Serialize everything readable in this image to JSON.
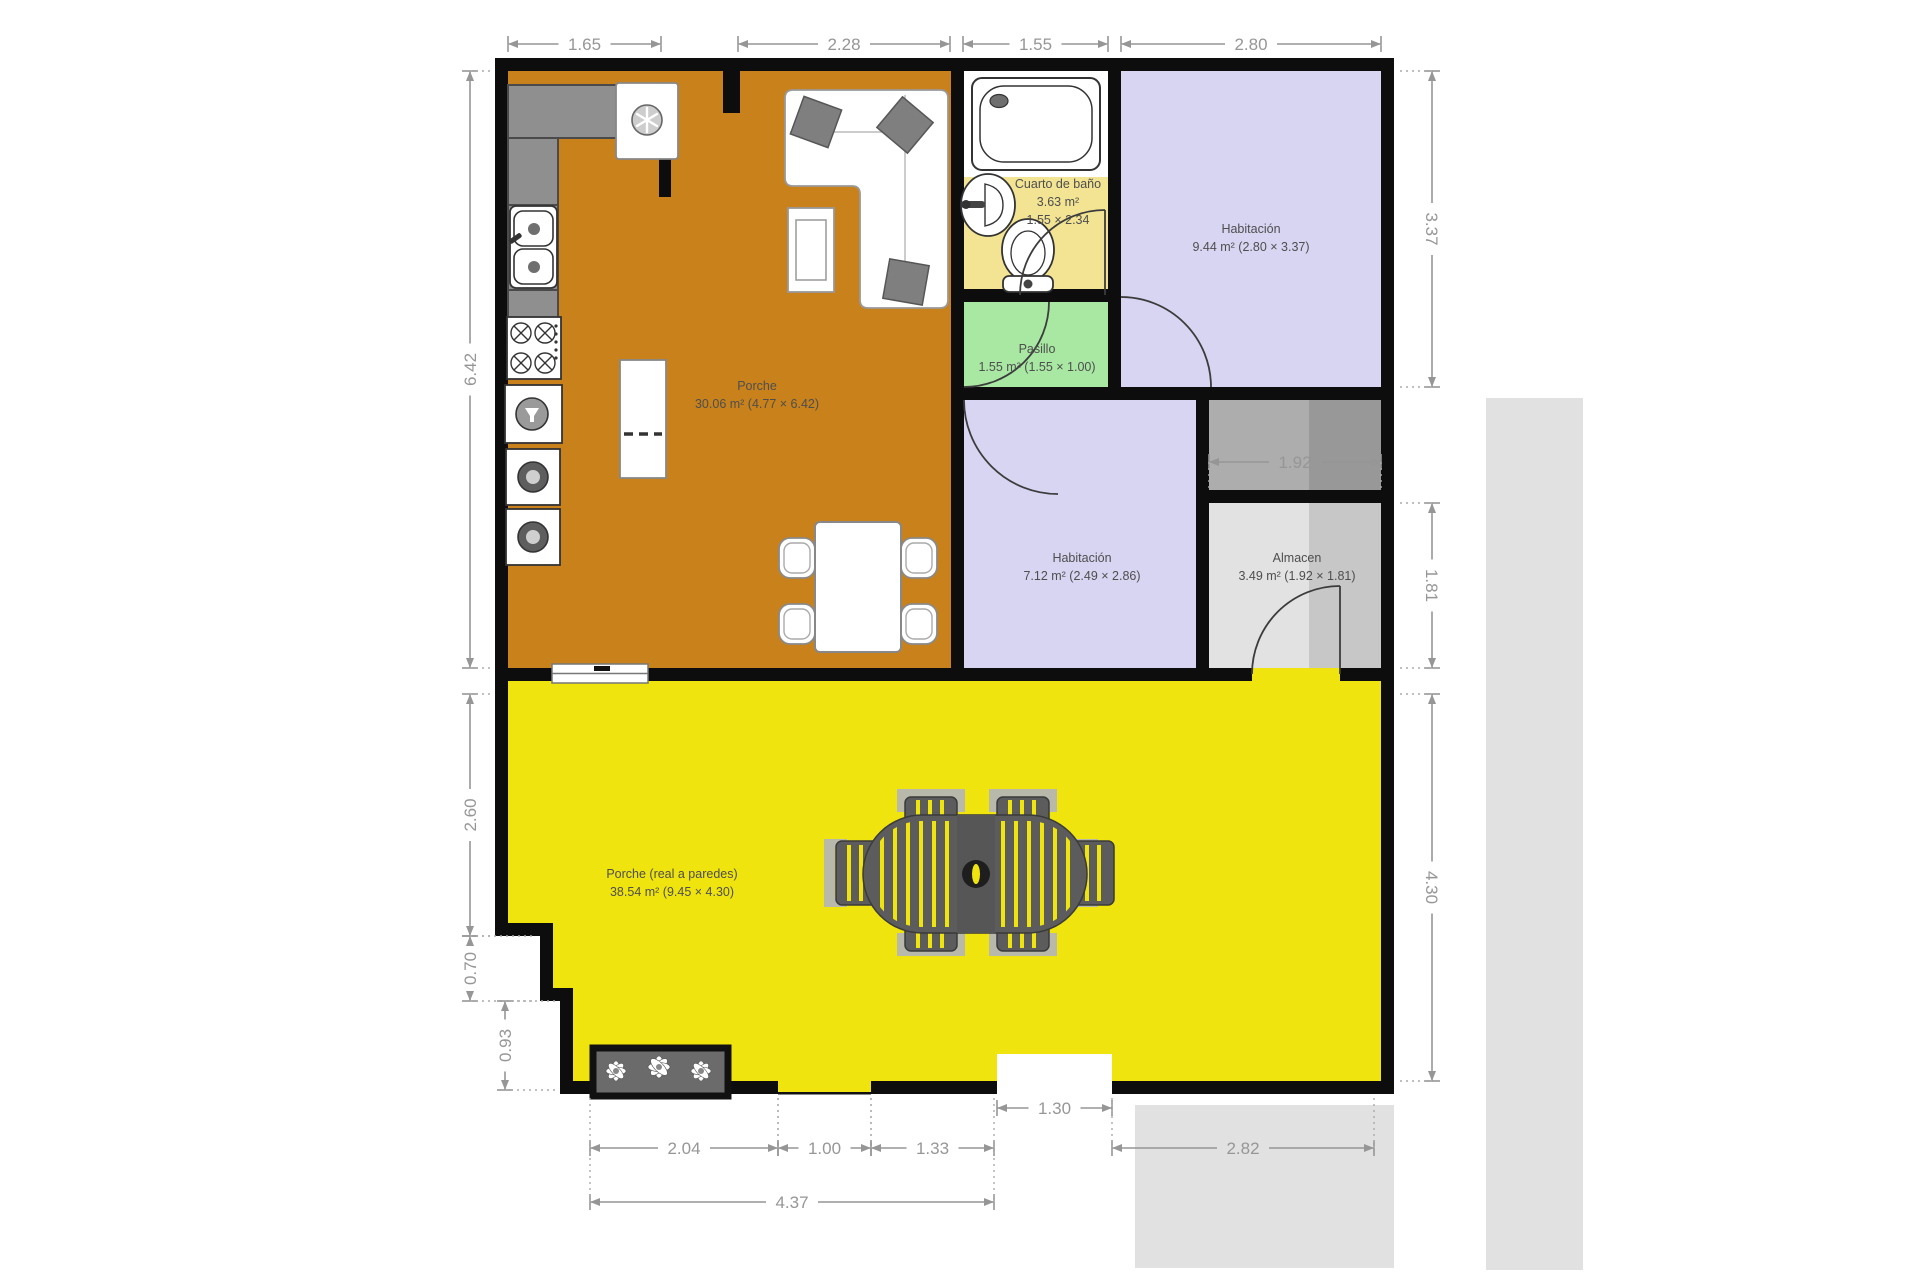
{
  "page": {
    "background": "#ffffff"
  },
  "floor_plan": {
    "colors": {
      "wall": "#0d0d0d",
      "living": "#C8811B",
      "bath": "#F3E494",
      "pasillo": "#A8E8A3",
      "bedroom": "#D8D5F2",
      "storage_light": "#E2E2E2",
      "storage_dark": "#C7C7C7",
      "porch": "#EFE40E",
      "exterior": "#E1E1E1",
      "counter": "#8F8F8F",
      "furniture_dark": "#5C5C5C",
      "dim_text": "#969696",
      "label_text": "#4E4E4E",
      "background": "#ffffff"
    },
    "rooms": [
      {
        "id": "porche-living",
        "name": "Porche",
        "line2": "30.06 m² (4.77 × 6.42)",
        "label_x": 757,
        "label_y": 390
      },
      {
        "id": "cuarto-de-bano",
        "name": "Cuarto de baño",
        "line2": "3.63 m²",
        "line3": "1.55 × 2.34",
        "label_x": 1058,
        "label_y": 188
      },
      {
        "id": "habitacion-1",
        "name": "Habitación",
        "line2": "9.44 m² (2.80 × 3.37)",
        "label_x": 1251,
        "label_y": 233
      },
      {
        "id": "pasillo",
        "name": "Pasillo",
        "line2": "1.55 m² (1.55 × 1.00)",
        "label_x": 1037,
        "label_y": 353
      },
      {
        "id": "habitacion-2",
        "name": "Habitación",
        "line2": "7.12 m² (2.49 × 2.86)",
        "label_x": 1082,
        "label_y": 562
      },
      {
        "id": "almacen",
        "name": "Almacen",
        "line2": "3.49 m² (1.92 × 1.81)",
        "label_x": 1297,
        "label_y": 562
      },
      {
        "id": "porche-exterior",
        "name": "Porche (real a paredes)",
        "line2": "38.54 m² (9.45 × 4.30)",
        "label_x": 672,
        "label_y": 878
      }
    ],
    "dimensions_m": [
      {
        "v": "1.65",
        "o": "h",
        "x1": 508,
        "x2": 661,
        "y": 44,
        "lead": "down",
        "ll": 12
      },
      {
        "v": "2.28",
        "o": "h",
        "x1": 738,
        "x2": 950,
        "y": 44,
        "lead": "down",
        "ll": 12
      },
      {
        "v": "1.55",
        "o": "h",
        "x1": 963,
        "x2": 1108,
        "y": 44,
        "lead": "down",
        "ll": 12
      },
      {
        "v": "2.80",
        "o": "h",
        "x1": 1121,
        "x2": 1381,
        "y": 44,
        "lead": "down",
        "ll": 12
      },
      {
        "v": "6.42",
        "o": "v",
        "y1": 71,
        "y2": 668,
        "x": 470,
        "lead": "right",
        "ll": 22
      },
      {
        "v": "2.60",
        "o": "v",
        "y1": 694,
        "y2": 936,
        "x": 470,
        "lead": "right",
        "ll": 22
      },
      {
        "v": "0.70",
        "o": "v",
        "y1": 936,
        "y2": 1001,
        "x": 470,
        "lead": "right",
        "ll": 62
      },
      {
        "v": "0.93",
        "o": "v",
        "y1": 1001,
        "y2": 1090,
        "x": 505,
        "lead": "right",
        "ll": 52
      },
      {
        "v": "3.37",
        "o": "v",
        "y1": 71,
        "y2": 387,
        "x": 1432,
        "lead": "left",
        "ll": 36
      },
      {
        "v": "1.81",
        "o": "v",
        "y1": 503,
        "y2": 668,
        "x": 1432,
        "lead": "left",
        "ll": 36
      },
      {
        "v": "4.30",
        "o": "v",
        "y1": 694,
        "y2": 1081,
        "x": 1432,
        "lead": "left",
        "ll": 36
      },
      {
        "v": "1.92",
        "o": "h",
        "x1": 1209,
        "x2": 1381,
        "y": 462,
        "lead": "down",
        "ll": 26
      },
      {
        "v": "1.30",
        "o": "h",
        "x1": 997,
        "x2": 1112,
        "y": 1108,
        "lead": "none",
        "ll": 0
      },
      {
        "v": "2.04",
        "o": "h",
        "x1": 590,
        "x2": 778,
        "y": 1148,
        "lead": "up",
        "ll": 52
      },
      {
        "v": "1.00",
        "o": "h",
        "x1": 778,
        "x2": 871,
        "y": 1148,
        "lead": "up",
        "ll": 52
      },
      {
        "v": "1.33",
        "o": "h",
        "x1": 871,
        "x2": 994,
        "y": 1148,
        "lead": "up",
        "ll": 52
      },
      {
        "v": "2.82",
        "o": "h",
        "x1": 1112,
        "x2": 1374,
        "y": 1148,
        "lead": "up",
        "ll": 52
      },
      {
        "v": "4.37",
        "o": "h",
        "x1": 590,
        "x2": 994,
        "y": 1202,
        "lead": "up",
        "ll": 50
      }
    ]
  }
}
